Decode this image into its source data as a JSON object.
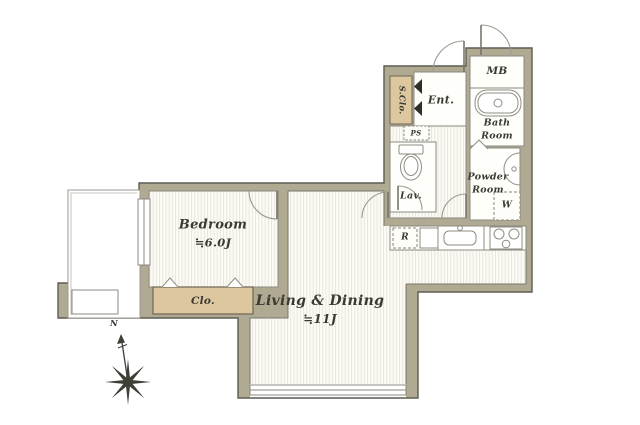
{
  "floorplan": {
    "rooms": {
      "bedroom": {
        "label": "Bedroom",
        "size": "≒6.0J"
      },
      "living_dining": {
        "label": "Living & Dining",
        "size": "≒11J"
      },
      "closet": {
        "label": "Clo."
      },
      "shoe_closet": {
        "label": "S.Clo."
      },
      "entrance": {
        "label": "Ent."
      },
      "meter_box": {
        "label": "MB"
      },
      "bath": {
        "line1": "Bath",
        "line2": "Room"
      },
      "powder": {
        "line1": "Powder",
        "line2": "Room"
      },
      "lavatory": {
        "label": "Lav."
      },
      "pipe_space": {
        "label": "PS"
      },
      "refrigerator": {
        "label": "R"
      },
      "washer": {
        "label": "W"
      }
    },
    "compass": {
      "north": "N"
    },
    "colors": {
      "wall": "#b1aa93",
      "outline": "#5c5c52",
      "closet_fill": "#dcc79e",
      "floor_stripe": "#e8e5da",
      "text": "#3a3a33"
    }
  }
}
